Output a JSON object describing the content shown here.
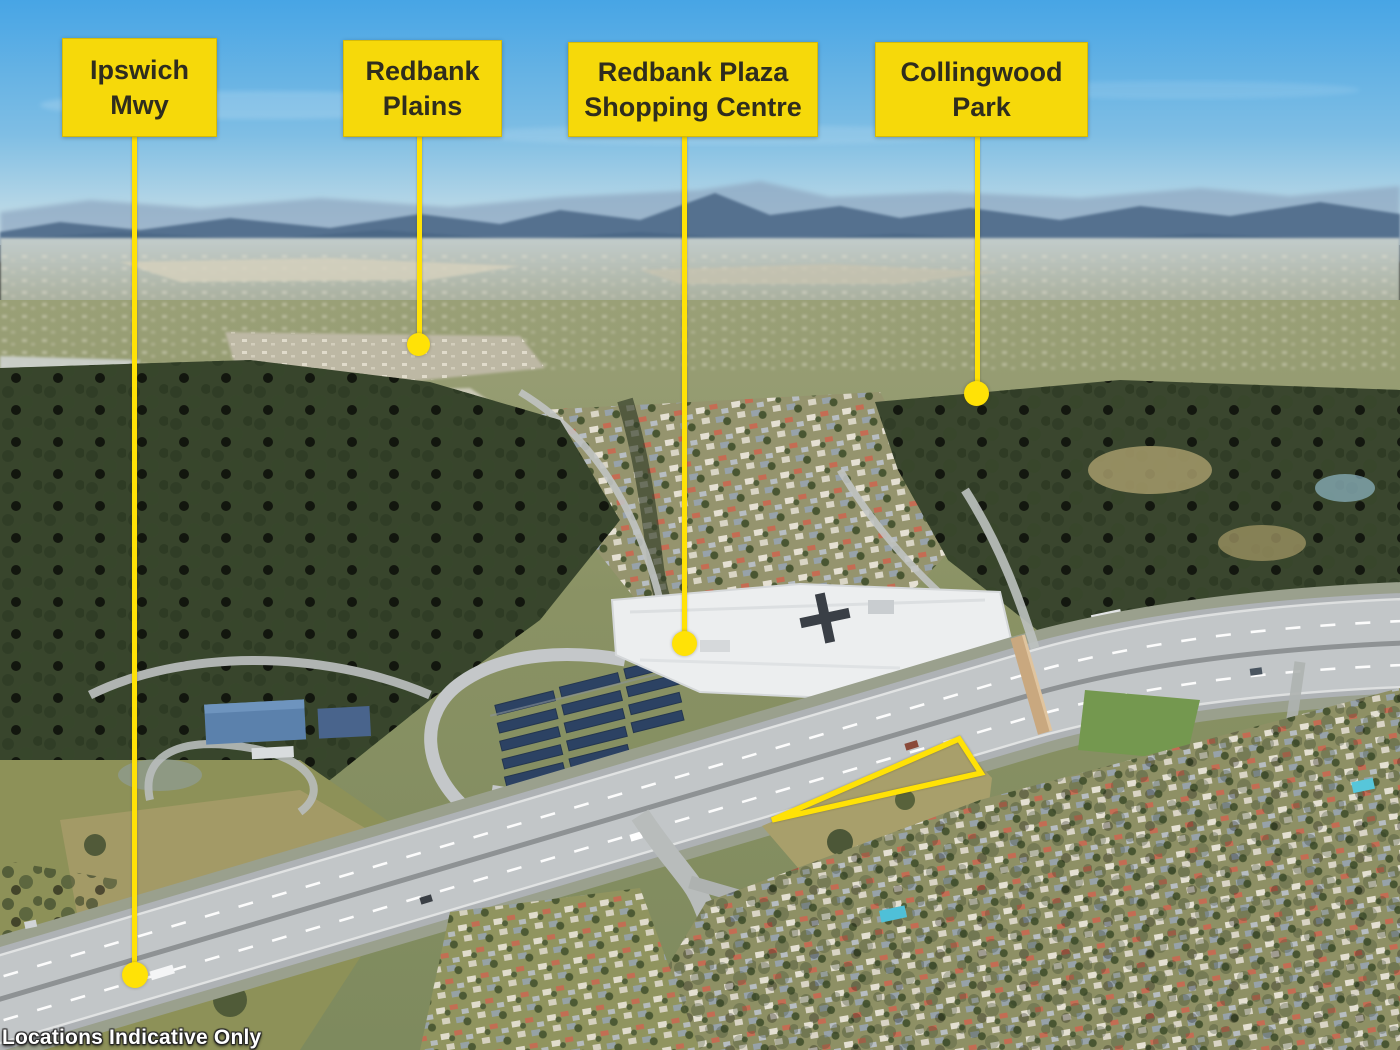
{
  "scene": {
    "type": "aerial-photograph",
    "disclaimer": "Locations Indicative Only"
  },
  "callouts": {
    "ipswich_mwy": {
      "line1": "Ipswich",
      "line2": "Mwy"
    },
    "redbank_plains": {
      "line1": "Redbank",
      "line2": "Plains"
    },
    "redbank_plaza": {
      "line1": "Redbank Plaza",
      "line2": "Shopping Centre"
    },
    "collingwood_park": {
      "line1": "Collingwood",
      "line2": "Park"
    }
  },
  "colors": {
    "callout_bg": "#F6D90A",
    "marker_yellow": "#FFE206",
    "label_text": "#2F2D1E",
    "sky_top": "#47A5E5",
    "mountains": "#54718F",
    "forest": "#38452C"
  }
}
